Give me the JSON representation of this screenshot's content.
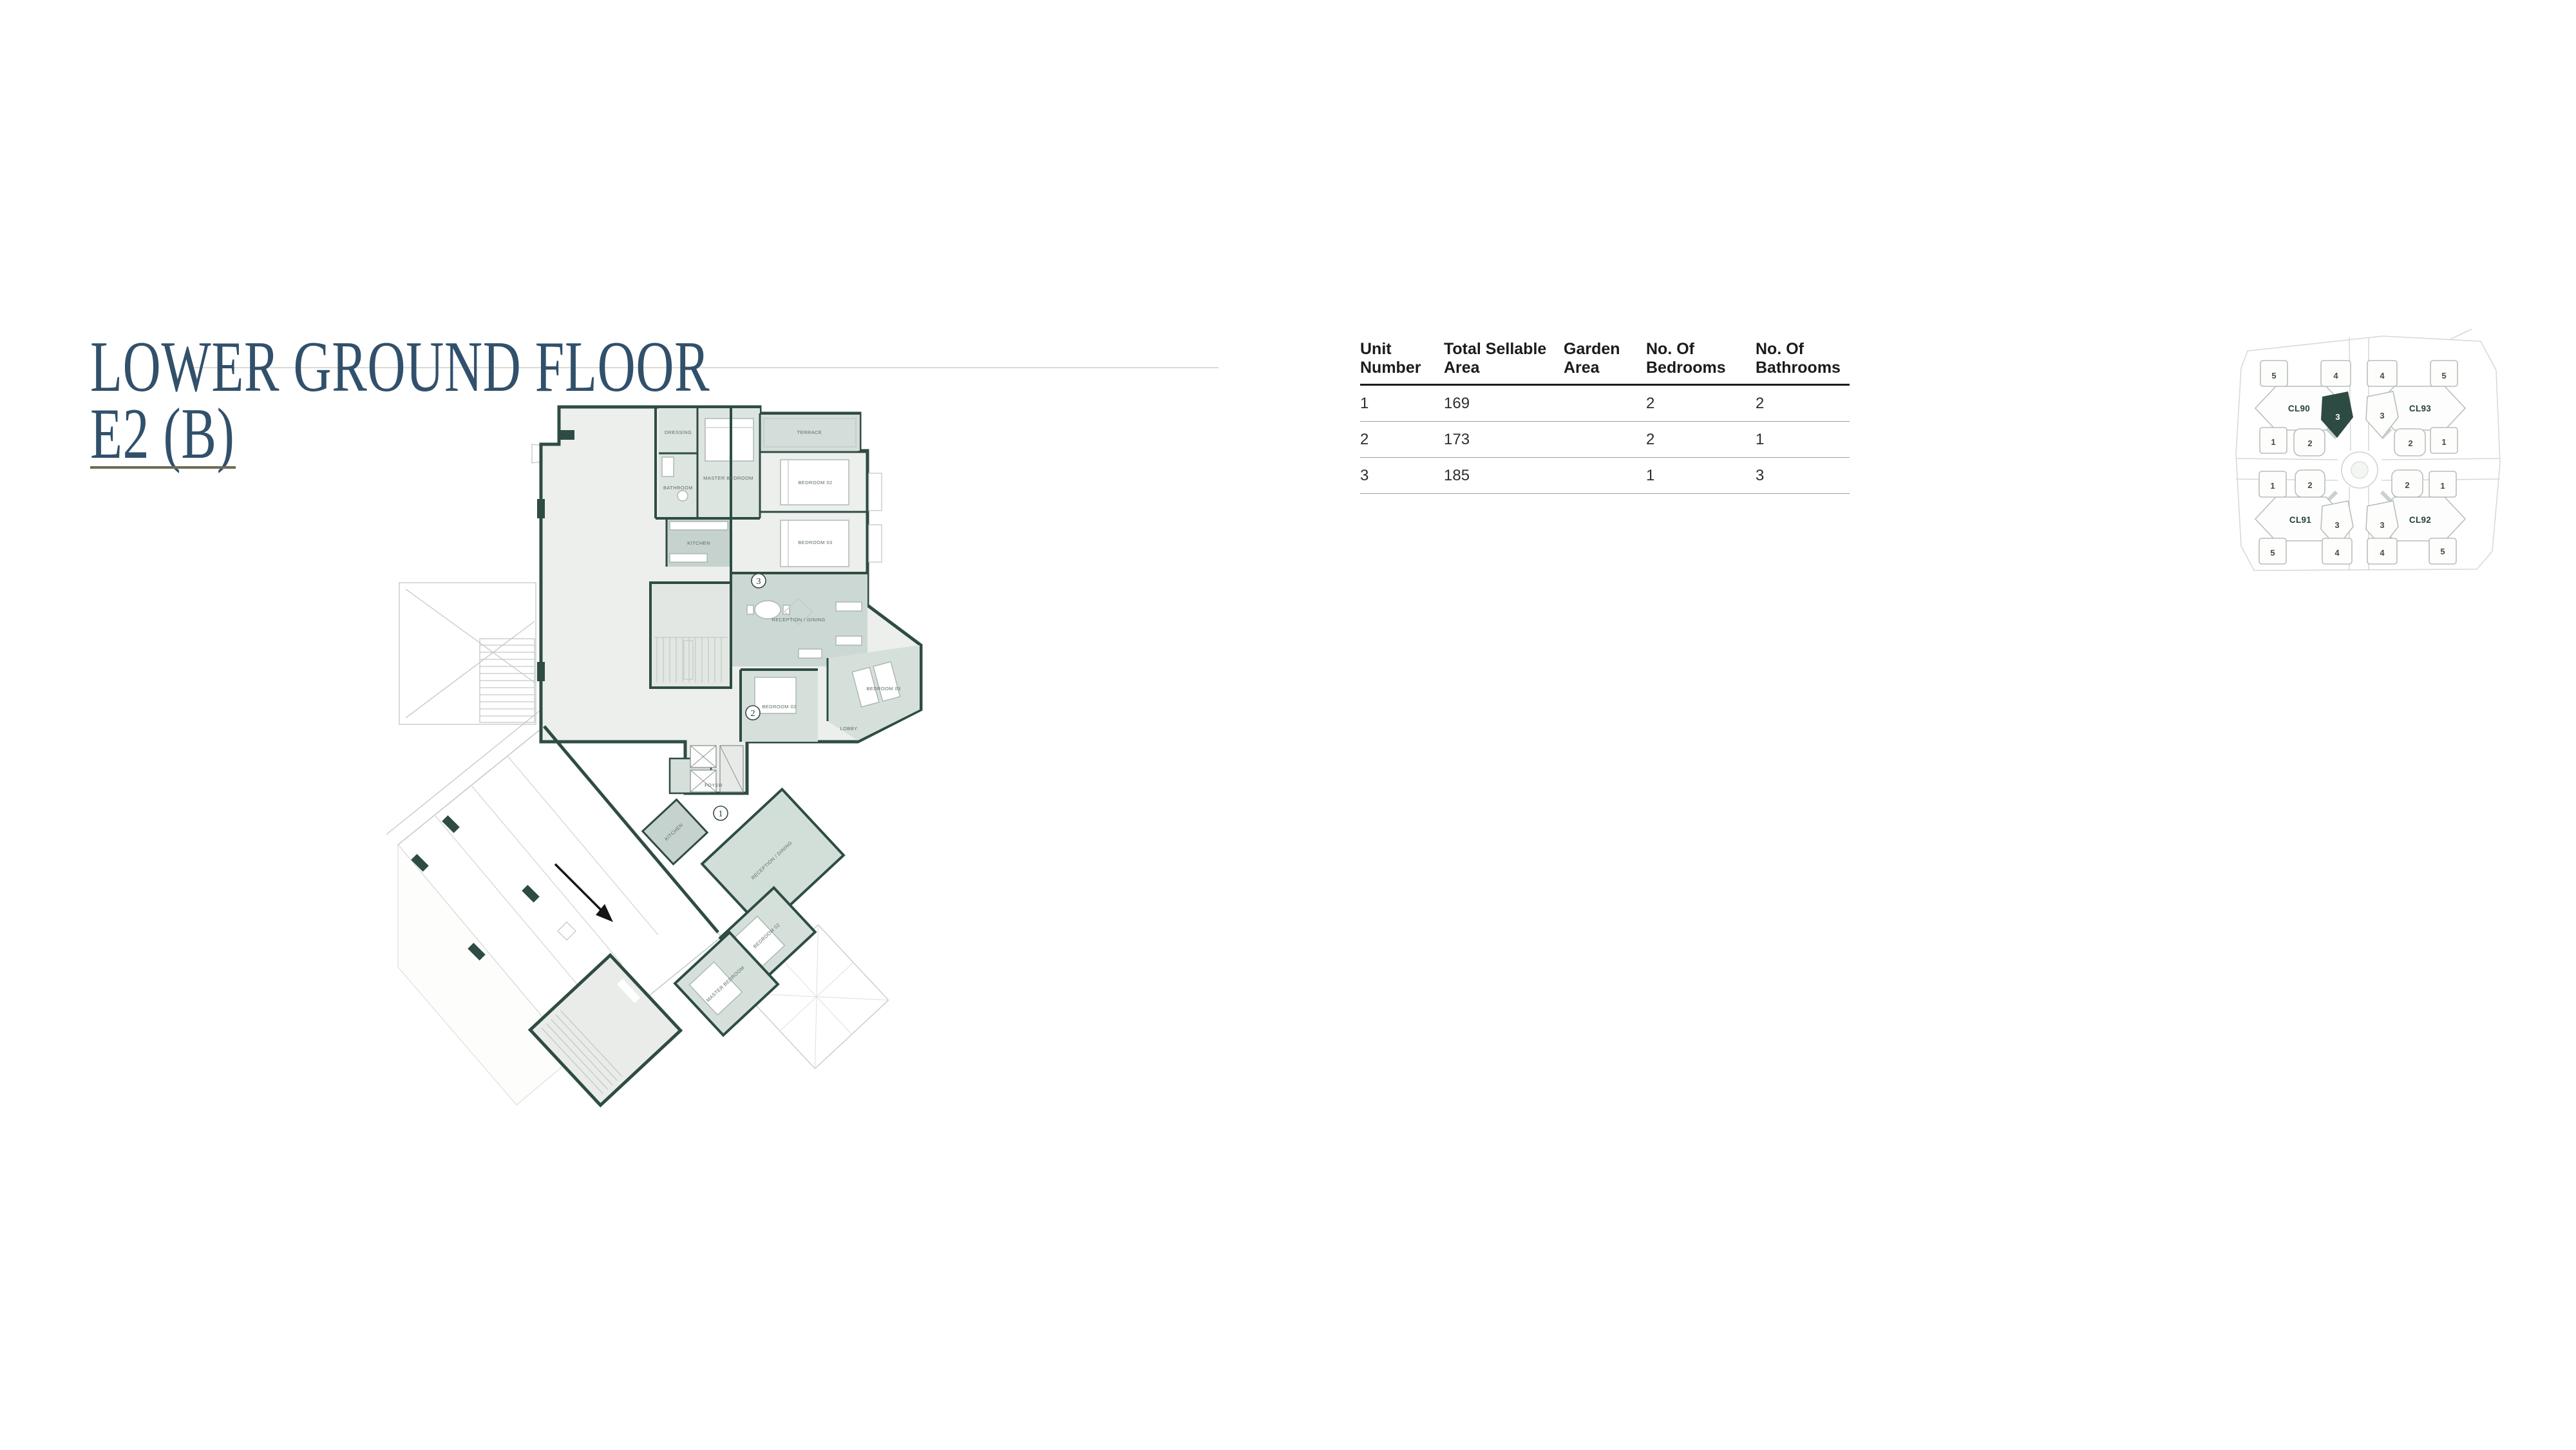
{
  "page": {
    "background": "#ffffff"
  },
  "title": {
    "line1": "LOWER GROUND FLOOR",
    "line2": "E2 (B)",
    "color": "#31506b",
    "underline_color": "#6f6d52"
  },
  "table": {
    "headers": [
      "Unit\nNumber",
      "Total Sellable\nArea",
      "Garden\nArea",
      "No. Of\nBedrooms",
      "No. Of\nBathrooms"
    ],
    "rows": [
      {
        "unit": "1",
        "sellable": "169",
        "garden": "",
        "bedrooms": "2",
        "bathrooms": "2"
      },
      {
        "unit": "2",
        "sellable": "173",
        "garden": "",
        "bedrooms": "2",
        "bathrooms": "1"
      },
      {
        "unit": "3",
        "sellable": "185",
        "garden": "",
        "bedrooms": "1",
        "bathrooms": "3"
      }
    ]
  },
  "floorplan": {
    "wall_color": "#2e4c43",
    "room_fill_light": "#ecefec",
    "room_fill_sage": "#ccd8d3",
    "unit_markers": [
      "3",
      "2",
      "1"
    ],
    "room_labels": [
      "DRESSING",
      "MASTER BEDROOM",
      "TERRACE",
      "BATHROOM",
      "BEDROOM 02",
      "BEDROOM 03",
      "KITCHEN",
      "RECEPTION / DINING",
      "BEDROOM 02",
      "BEDROOM 03",
      "LOBBY",
      "KITCHEN",
      "RECEPTION / DINING",
      "BEDROOM 02",
      "MASTER BEDROOM",
      "FOYER"
    ]
  },
  "sitemap": {
    "highlight_color": "#2d4b43",
    "clusters": [
      {
        "name": "CL90",
        "units": [
          "5",
          "4",
          "3",
          "1",
          "2"
        ]
      },
      {
        "name": "CL93",
        "units": [
          "4",
          "5",
          "3",
          "2",
          "1"
        ]
      },
      {
        "name": "CL91",
        "units": [
          "1",
          "2",
          "3",
          "5",
          "4"
        ]
      },
      {
        "name": "CL92",
        "units": [
          "2",
          "1",
          "3",
          "4",
          "5"
        ]
      }
    ]
  }
}
